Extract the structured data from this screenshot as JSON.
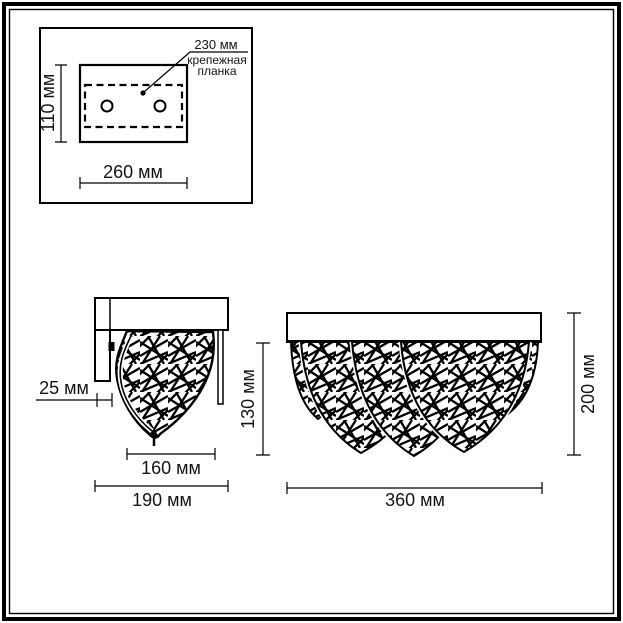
{
  "colors": {
    "line": "#000000",
    "background": "#ffffff"
  },
  "mounting_plate_view": {
    "callout_value": "230 мм",
    "callout_label_line1": "крепежная",
    "callout_label_line2": "планка",
    "height_dim": "110 мм",
    "width_dim": "260 мм"
  },
  "side_view": {
    "depth_dim": "25 мм",
    "shade_width_dim": "160 мм",
    "total_width_dim": "190 мм",
    "height_dim": "130 мм"
  },
  "front_view": {
    "width_dim": "360 мм",
    "height_dim": "200 мм"
  }
}
